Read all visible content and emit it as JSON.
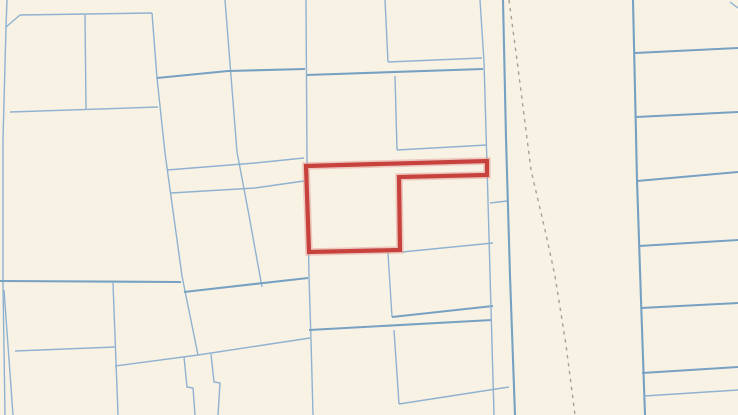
{
  "map": {
    "kind": "cadastral-parcel-map",
    "canvas": {
      "width": 738,
      "height": 415
    },
    "colors": {
      "background": "#f8f2e5",
      "parcel_line_minor": "#8fb2d0",
      "parcel_line_major": "#77a1c3",
      "road_dash": "#a8a296",
      "highlight_stroke": "#c8423d",
      "highlight_halo": "#e0928c"
    },
    "stroke_widths": {
      "minor": 1.4,
      "major": 2.1,
      "dash": 1.4,
      "highlight": 4.2,
      "highlight_halo": 7.5
    },
    "dash_pattern": "3.5 4.5",
    "highlight_parcel": {
      "closed": true,
      "points": [
        [
          306,
          166
        ],
        [
          487,
          161
        ],
        [
          487,
          175
        ],
        [
          399,
          177
        ],
        [
          400,
          250
        ],
        [
          309,
          252
        ]
      ]
    },
    "dashed_lines": [
      {
        "points": [
          [
            509,
            0
          ],
          [
            517,
            60
          ],
          [
            531,
            170
          ],
          [
            545,
            230
          ],
          [
            555,
            276
          ],
          [
            566,
            345
          ],
          [
            575,
            415
          ]
        ]
      }
    ],
    "parcel_lines": [
      {
        "major": false,
        "points": [
          [
            7,
            0
          ],
          [
            6,
            27
          ]
        ]
      },
      {
        "major": false,
        "points": [
          [
            6,
            27
          ],
          [
            20,
            15
          ]
        ]
      },
      {
        "major": false,
        "points": [
          [
            20,
            15
          ],
          [
            152,
            13
          ]
        ]
      },
      {
        "major": false,
        "points": [
          [
            152,
            13
          ],
          [
            157,
            78
          ],
          [
            165,
            153
          ],
          [
            182,
            276
          ],
          [
            185,
            291
          ],
          [
            198,
            355
          ]
        ]
      },
      {
        "major": false,
        "points": [
          [
            85,
            15
          ],
          [
            86,
            110
          ]
        ]
      },
      {
        "major": false,
        "points": [
          [
            10,
            112
          ],
          [
            158,
            107
          ]
        ]
      },
      {
        "major": false,
        "points": [
          [
            6,
            27
          ],
          [
            3,
            140
          ],
          [
            3,
            283
          ]
        ]
      },
      {
        "major": false,
        "points": [
          [
            225,
            0
          ],
          [
            237,
            152
          ],
          [
            248,
            210
          ],
          [
            262,
            287
          ]
        ]
      },
      {
        "major": true,
        "points": [
          [
            157,
            78
          ],
          [
            228,
            71
          ],
          [
            305,
            69
          ]
        ]
      },
      {
        "major": true,
        "points": [
          [
            306,
            75
          ],
          [
            483,
            69
          ]
        ]
      },
      {
        "major": false,
        "points": [
          [
            167,
            170
          ],
          [
            255,
            163
          ],
          [
            304,
            158
          ]
        ]
      },
      {
        "major": false,
        "points": [
          [
            171,
            193
          ],
          [
            255,
            188
          ],
          [
            304,
            181
          ]
        ]
      },
      {
        "major": true,
        "points": [
          [
            0,
            281
          ],
          [
            181,
            282
          ]
        ]
      },
      {
        "major": true,
        "points": [
          [
            184,
            292
          ],
          [
            308,
            278
          ]
        ]
      },
      {
        "major": false,
        "points": [
          [
            3,
            283
          ],
          [
            5,
            415
          ]
        ]
      },
      {
        "major": false,
        "points": [
          [
            4,
            290
          ],
          [
            13,
            415
          ]
        ]
      },
      {
        "major": false,
        "points": [
          [
            113,
            283
          ],
          [
            118,
            415
          ]
        ]
      },
      {
        "major": false,
        "points": [
          [
            15,
            351
          ],
          [
            115,
            347
          ]
        ]
      },
      {
        "major": false,
        "points": [
          [
            115,
            366
          ],
          [
            198,
            355
          ],
          [
            310,
            338
          ]
        ]
      },
      {
        "major": false,
        "points": [
          [
            184,
            357
          ],
          [
            187,
            387
          ],
          [
            193,
            388
          ],
          [
            195,
            415
          ]
        ]
      },
      {
        "major": false,
        "points": [
          [
            211,
            354
          ],
          [
            214,
            382
          ],
          [
            220,
            383
          ],
          [
            218,
            415
          ]
        ]
      },
      {
        "major": false,
        "points": [
          [
            306,
            0
          ],
          [
            307,
            160
          ],
          [
            309,
            277
          ],
          [
            311,
            340
          ],
          [
            313,
            415
          ]
        ]
      },
      {
        "major": false,
        "points": [
          [
            385,
            0
          ],
          [
            388,
            62
          ]
        ]
      },
      {
        "major": false,
        "points": [
          [
            388,
            62
          ],
          [
            482,
            58
          ]
        ]
      },
      {
        "major": false,
        "points": [
          [
            395,
            76
          ],
          [
            397,
            150
          ]
        ]
      },
      {
        "major": false,
        "points": [
          [
            397,
            150
          ],
          [
            487,
            145
          ]
        ]
      },
      {
        "major": false,
        "points": [
          [
            402,
            252
          ],
          [
            493,
            243
          ]
        ]
      },
      {
        "major": false,
        "points": [
          [
            388,
            253
          ],
          [
            392,
            317
          ]
        ]
      },
      {
        "major": true,
        "points": [
          [
            392,
            317
          ],
          [
            493,
            306
          ]
        ]
      },
      {
        "major": true,
        "points": [
          [
            309,
            330
          ],
          [
            492,
            320
          ]
        ]
      },
      {
        "major": false,
        "points": [
          [
            394,
            330
          ],
          [
            399,
            404
          ]
        ]
      },
      {
        "major": false,
        "points": [
          [
            399,
            404
          ],
          [
            509,
            387
          ]
        ]
      },
      {
        "major": false,
        "points": [
          [
            490,
            203
          ],
          [
            507,
            201
          ]
        ]
      },
      {
        "major": false,
        "points": [
          [
            480,
            0
          ],
          [
            484,
            62
          ],
          [
            487,
            165
          ],
          [
            490,
            273
          ],
          [
            494,
            415
          ]
        ]
      },
      {
        "major": true,
        "points": [
          [
            503,
            0
          ],
          [
            506,
            138
          ],
          [
            510,
            276
          ],
          [
            515,
            415
          ]
        ]
      },
      {
        "major": true,
        "points": [
          [
            633,
            0
          ],
          [
            637,
            180
          ],
          [
            641,
            300
          ],
          [
            645,
            415
          ]
        ]
      },
      {
        "major": false,
        "points": [
          [
            730,
            2
          ],
          [
            738,
            8
          ]
        ]
      },
      {
        "major": true,
        "points": [
          [
            635,
            53
          ],
          [
            738,
            48
          ]
        ]
      },
      {
        "major": true,
        "points": [
          [
            636,
            117
          ],
          [
            738,
            112
          ]
        ]
      },
      {
        "major": true,
        "points": [
          [
            637,
            181
          ],
          [
            738,
            172
          ]
        ]
      },
      {
        "major": true,
        "points": [
          [
            639,
            246
          ],
          [
            738,
            240
          ]
        ]
      },
      {
        "major": true,
        "points": [
          [
            641,
            308
          ],
          [
            738,
            303
          ]
        ]
      },
      {
        "major": true,
        "points": [
          [
            642,
            373
          ],
          [
            738,
            367
          ]
        ]
      },
      {
        "major": false,
        "points": [
          [
            644,
            396
          ],
          [
            738,
            390
          ]
        ]
      }
    ]
  }
}
